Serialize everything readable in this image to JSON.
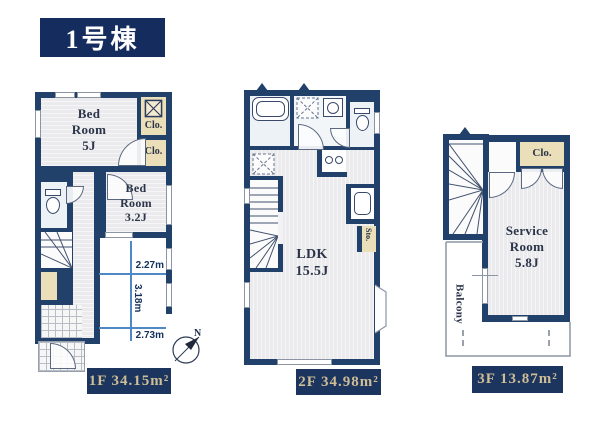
{
  "title": "1号棟",
  "compass": {
    "north": "N"
  },
  "colors": {
    "wall_navy": "#21406a",
    "title_bg": "#142c5e",
    "label_box_bg": "#1b355f",
    "area_text_gold": "#cebd95",
    "closet_beige": "#eadfb9",
    "dimension_blue": "#4f88c7",
    "room_text": "#2b3448"
  },
  "icons": {
    "compass": "compass-rose-icon",
    "stairs": "stairs-icon",
    "toilet": "toilet-icon",
    "bathtub": "bathtub-icon",
    "stove": "stove-icon",
    "kitchen_sink": "kitchen-sink-icon",
    "vanity_sink": "vanity-sink-icon",
    "washer_space": "washer-space-icon",
    "closet_cross_box": "closet-shelf-icon",
    "bay_window": "bay-window-icon"
  },
  "floor1": {
    "bedroom5_label": "Bed\nRoom\n5J",
    "closet_top_label": "Clo.",
    "closet_mid_label": "Clo.",
    "bedroom32_label": "Bed\nRoom\n3.2J",
    "dim_top": "2.27m",
    "dim_vertical": "3.18m",
    "dim_bottom": "2.73m",
    "area_label": "1F 34.15m²"
  },
  "floor2": {
    "ldk_label": "LDK\n15.5J",
    "storage_label": "Sto.",
    "area_label": "2F 34.98m²"
  },
  "floor3": {
    "closet_label": "Clo.",
    "service_room_label": "Service\nRoom\n5.8J",
    "balcony_label": "Balcony",
    "area_label": "3F 13.87m²"
  }
}
